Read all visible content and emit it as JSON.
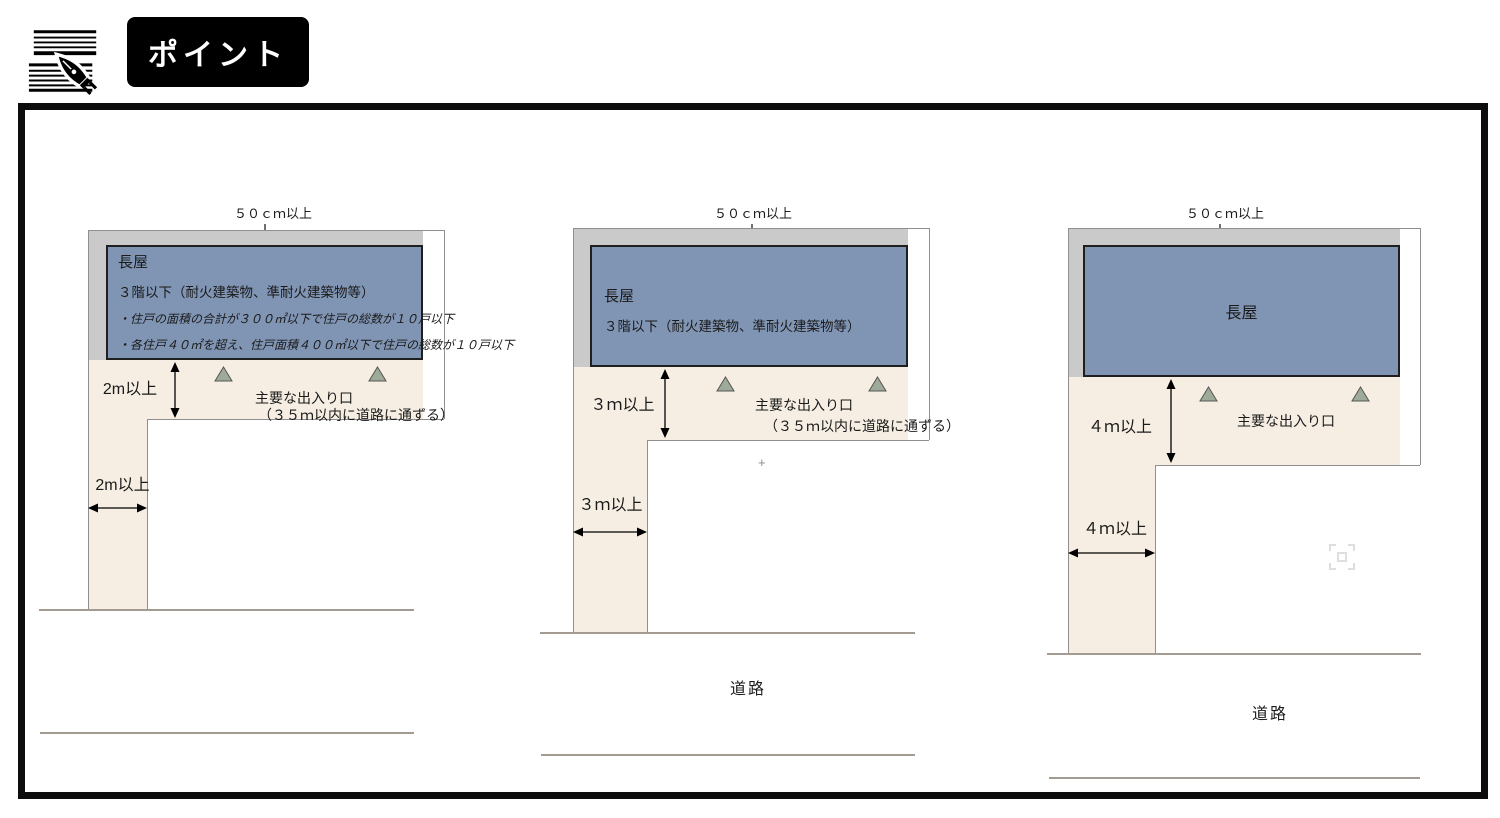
{
  "header": {
    "icon": "pen-writing-on-lines-icon",
    "title": "ポイント"
  },
  "panels": [
    {
      "gap_label": "５０ｃｍ以上",
      "building_name": "長屋",
      "building_spec": "３階以下（耐火建築物、準耐火建築物等）",
      "building_notes": [
        "・住戸の面積の合計が３００㎡以下で住戸の総数が１０戸以下",
        "・各住戸４０㎡を超え、住戸面積４００㎡以下で住戸の総数が１０戸以下"
      ],
      "setback_label": "2m以上",
      "passage_label": "2m以上",
      "entrance_label": "主要な出入り口",
      "entrance_note": "（３５ｍ以内に道路に通ずる）"
    },
    {
      "gap_label": "５０ｃｍ以上",
      "building_name": "長屋",
      "building_spec": "３階以下（耐火建築物、準耐火建築物等）",
      "setback_label": "３ｍ以上",
      "passage_label": "３ｍ以上",
      "entrance_label": "主要な出入り口",
      "entrance_note": "（３５ｍ以内に道路に通ずる）",
      "plus_marker": "+",
      "road_label": "道路"
    },
    {
      "gap_label": "５０ｃｍ以上",
      "building_name": "長屋",
      "setback_label": "４ｍ以上",
      "passage_label": "４ｍ以上",
      "entrance_label": "主要な出入り口",
      "road_label": "道路"
    }
  ],
  "colors": {
    "building_fill": "#8095b4",
    "building_border": "#1f1f1f",
    "offset_band": "#cacaca",
    "passage_fill": "#f6eee3",
    "entrance_marker_fill": "#9fab9a",
    "frame_border": "#0d0d0d",
    "road_line": "#a39b92"
  }
}
